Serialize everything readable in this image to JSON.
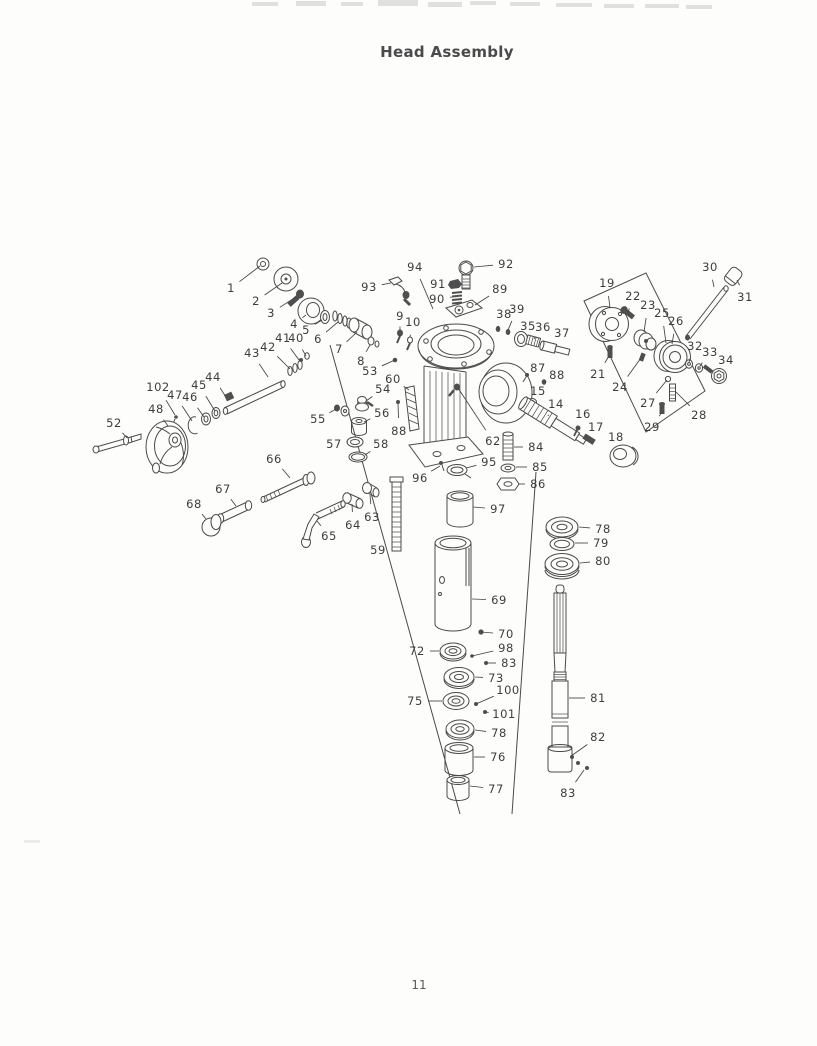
{
  "page": {
    "title": "Head Assembly",
    "page_number": "11"
  },
  "diagram": {
    "callouts": [
      {
        "n": "1",
        "x": 231,
        "y": 288,
        "tx": 260,
        "ty": 266
      },
      {
        "n": "2",
        "x": 256,
        "y": 301,
        "tx": 282,
        "ty": 283
      },
      {
        "n": "3",
        "x": 271,
        "y": 313,
        "tx": 296,
        "ty": 297
      },
      {
        "n": "4",
        "x": 294,
        "y": 324,
        "tx": 306,
        "ty": 315
      },
      {
        "n": "5",
        "x": 306,
        "y": 330,
        "tx": 322,
        "ty": 320
      },
      {
        "n": "6",
        "x": 318,
        "y": 339,
        "tx": 338,
        "ty": 322
      },
      {
        "n": "7",
        "x": 339,
        "y": 349,
        "tx": 357,
        "ty": 332
      },
      {
        "n": "8",
        "x": 361,
        "y": 361,
        "tx": 370,
        "ty": 345
      },
      {
        "n": "9",
        "x": 400,
        "y": 316,
        "tx": 400,
        "ty": 330
      },
      {
        "n": "10",
        "x": 413,
        "y": 322,
        "tx": 410,
        "ty": 337
      },
      {
        "n": "93",
        "x": 369,
        "y": 287,
        "tx": 391,
        "ty": 283
      },
      {
        "n": "94",
        "x": 415,
        "y": 267,
        "tx": 433,
        "ty": 309
      },
      {
        "n": "92",
        "x": 506,
        "y": 264,
        "tx": 474,
        "ty": 267
      },
      {
        "n": "91",
        "x": 438,
        "y": 284,
        "tx": 452,
        "ty": 284
      },
      {
        "n": "90",
        "x": 437,
        "y": 299,
        "tx": 452,
        "ty": 297
      },
      {
        "n": "89",
        "x": 500,
        "y": 289,
        "tx": 475,
        "ty": 305
      },
      {
        "n": "38",
        "x": 504,
        "y": 314,
        "tx": 498,
        "ty": 327
      },
      {
        "n": "39",
        "x": 517,
        "y": 309,
        "tx": 508,
        "ty": 330
      },
      {
        "n": "35",
        "x": 528,
        "y": 326,
        "tx": 521,
        "ty": 336
      },
      {
        "n": "36",
        "x": 543,
        "y": 327,
        "tx": 534,
        "ty": 339
      },
      {
        "n": "37",
        "x": 562,
        "y": 333,
        "tx": 553,
        "ty": 344
      },
      {
        "n": "87",
        "x": 538,
        "y": 368,
        "tx": 527,
        "ty": 376
      },
      {
        "n": "88",
        "x": 557,
        "y": 375,
        "tx": 544,
        "ty": 382
      },
      {
        "n": "15",
        "x": 538,
        "y": 391,
        "tx": 532,
        "ty": 401
      },
      {
        "n": "14",
        "x": 556,
        "y": 404,
        "tx": 548,
        "ty": 416
      },
      {
        "n": "16",
        "x": 583,
        "y": 414,
        "tx": 578,
        "ty": 427
      },
      {
        "n": "17",
        "x": 596,
        "y": 427,
        "tx": 589,
        "ty": 437
      },
      {
        "n": "18",
        "x": 616,
        "y": 437,
        "tx": 621,
        "ty": 448
      },
      {
        "n": "19",
        "x": 607,
        "y": 283,
        "tx": 610,
        "ty": 308
      },
      {
        "n": "21",
        "x": 598,
        "y": 374,
        "tx": 609,
        "ty": 356
      },
      {
        "n": "22",
        "x": 633,
        "y": 296,
        "tx": 628,
        "ty": 313
      },
      {
        "n": "23",
        "x": 648,
        "y": 305,
        "tx": 644,
        "ty": 332
      },
      {
        "n": "24",
        "x": 620,
        "y": 387,
        "tx": 641,
        "ty": 358
      },
      {
        "n": "25",
        "x": 662,
        "y": 313,
        "tx": 666,
        "ty": 343
      },
      {
        "n": "26",
        "x": 676,
        "y": 321,
        "tx": 672,
        "ty": 344
      },
      {
        "n": "30",
        "x": 710,
        "y": 267,
        "tx": 714,
        "ty": 287
      },
      {
        "n": "31",
        "x": 745,
        "y": 297,
        "tx": 737,
        "ty": 280
      },
      {
        "n": "32",
        "x": 695,
        "y": 346,
        "tx": 689,
        "ty": 362
      },
      {
        "n": "33",
        "x": 710,
        "y": 352,
        "tx": 700,
        "ty": 366
      },
      {
        "n": "34",
        "x": 726,
        "y": 360,
        "tx": 720,
        "ty": 370
      },
      {
        "n": "27",
        "x": 648,
        "y": 403,
        "tx": 667,
        "ty": 380
      },
      {
        "n": "28",
        "x": 699,
        "y": 415,
        "tx": 676,
        "ty": 392
      },
      {
        "n": "29",
        "x": 652,
        "y": 427,
        "tx": 662,
        "ty": 412
      },
      {
        "n": "43",
        "x": 252,
        "y": 353,
        "tx": 268,
        "ty": 377
      },
      {
        "n": "42",
        "x": 268,
        "y": 347,
        "tx": 290,
        "ty": 369
      },
      {
        "n": "41",
        "x": 283,
        "y": 338,
        "tx": 299,
        "ty": 360
      },
      {
        "n": "40",
        "x": 296,
        "y": 338,
        "tx": 306,
        "ty": 356
      },
      {
        "n": "44",
        "x": 213,
        "y": 377,
        "tx": 226,
        "ty": 397
      },
      {
        "n": "45",
        "x": 199,
        "y": 385,
        "tx": 215,
        "ty": 411
      },
      {
        "n": "46",
        "x": 190,
        "y": 397,
        "tx": 204,
        "ty": 417
      },
      {
        "n": "47",
        "x": 175,
        "y": 395,
        "tx": 192,
        "ty": 421
      },
      {
        "n": "102",
        "x": 158,
        "y": 387,
        "tx": 175,
        "ty": 415
      },
      {
        "n": "48",
        "x": 156,
        "y": 409,
        "tx": 168,
        "ty": 426
      },
      {
        "n": "52",
        "x": 114,
        "y": 423,
        "tx": 127,
        "ty": 438
      },
      {
        "n": "53",
        "x": 370,
        "y": 371,
        "tx": 395,
        "ty": 360
      },
      {
        "n": "60",
        "x": 393,
        "y": 379,
        "tx": 409,
        "ty": 390
      },
      {
        "n": "54",
        "x": 383,
        "y": 389,
        "tx": 366,
        "ty": 401
      },
      {
        "n": "55",
        "x": 318,
        "y": 419,
        "tx": 336,
        "ty": 409
      },
      {
        "n": "56",
        "x": 382,
        "y": 413,
        "tx": 364,
        "ty": 422
      },
      {
        "n": "57",
        "x": 334,
        "y": 444,
        "tx": 348,
        "ty": 442
      },
      {
        "n": "58",
        "x": 381,
        "y": 444,
        "tx": 365,
        "ty": 455
      },
      {
        "n": "88",
        "x": 399,
        "y": 431,
        "tx": 398,
        "ty": 403
      },
      {
        "n": "62",
        "x": 493,
        "y": 441,
        "tx": 458,
        "ty": 388
      },
      {
        "n": "84",
        "x": 536,
        "y": 447,
        "tx": 514,
        "ty": 447
      },
      {
        "n": "85",
        "x": 540,
        "y": 467,
        "tx": 516,
        "ty": 467
      },
      {
        "n": "86",
        "x": 538,
        "y": 484,
        "tx": 519,
        "ty": 484
      },
      {
        "n": "95",
        "x": 489,
        "y": 462,
        "tx": 466,
        "ty": 468
      },
      {
        "n": "96",
        "x": 420,
        "y": 478,
        "tx": 440,
        "ty": 466
      },
      {
        "n": "97",
        "x": 498,
        "y": 509,
        "tx": 473,
        "ty": 507
      },
      {
        "n": "66",
        "x": 274,
        "y": 459,
        "tx": 290,
        "ty": 478
      },
      {
        "n": "67",
        "x": 223,
        "y": 489,
        "tx": 236,
        "ty": 506
      },
      {
        "n": "68",
        "x": 194,
        "y": 504,
        "tx": 206,
        "ty": 519
      },
      {
        "n": "65",
        "x": 329,
        "y": 536,
        "tx": 317,
        "ty": 521
      },
      {
        "n": "64",
        "x": 353,
        "y": 525,
        "tx": 352,
        "ty": 504
      },
      {
        "n": "63",
        "x": 372,
        "y": 517,
        "tx": 370,
        "ty": 495
      },
      {
        "n": "59",
        "x": 378,
        "y": 550,
        "tx": 391,
        "ty": 549
      },
      {
        "n": "78",
        "x": 603,
        "y": 529,
        "tx": 579,
        "ty": 527
      },
      {
        "n": "79",
        "x": 601,
        "y": 543,
        "tx": 575,
        "ty": 543
      },
      {
        "n": "80",
        "x": 603,
        "y": 561,
        "tx": 580,
        "ty": 563
      },
      {
        "n": "69",
        "x": 499,
        "y": 600,
        "tx": 472,
        "ty": 599
      },
      {
        "n": "70",
        "x": 506,
        "y": 634,
        "tx": 481,
        "ty": 632
      },
      {
        "n": "72",
        "x": 417,
        "y": 651,
        "tx": 439,
        "ty": 651
      },
      {
        "n": "98",
        "x": 506,
        "y": 648,
        "tx": 472,
        "ty": 656
      },
      {
        "n": "83",
        "x": 509,
        "y": 663,
        "tx": 486,
        "ty": 663
      },
      {
        "n": "73",
        "x": 496,
        "y": 678,
        "tx": 475,
        "ty": 677
      },
      {
        "n": "100",
        "x": 508,
        "y": 690,
        "tx": 476,
        "ty": 704
      },
      {
        "n": "75",
        "x": 415,
        "y": 701,
        "tx": 442,
        "ty": 701
      },
      {
        "n": "101",
        "x": 504,
        "y": 714,
        "tx": 485,
        "ty": 712
      },
      {
        "n": "78",
        "x": 499,
        "y": 733,
        "tx": 475,
        "ty": 730
      },
      {
        "n": "76",
        "x": 498,
        "y": 757,
        "tx": 474,
        "ty": 757
      },
      {
        "n": "77",
        "x": 496,
        "y": 789,
        "tx": 470,
        "ty": 786
      },
      {
        "n": "81",
        "x": 598,
        "y": 698,
        "tx": 569,
        "ty": 698
      },
      {
        "n": "82",
        "x": 598,
        "y": 737,
        "tx": 571,
        "ty": 756
      },
      {
        "n": "83",
        "x": 568,
        "y": 793,
        "tx": 584,
        "ty": 770
      }
    ]
  }
}
